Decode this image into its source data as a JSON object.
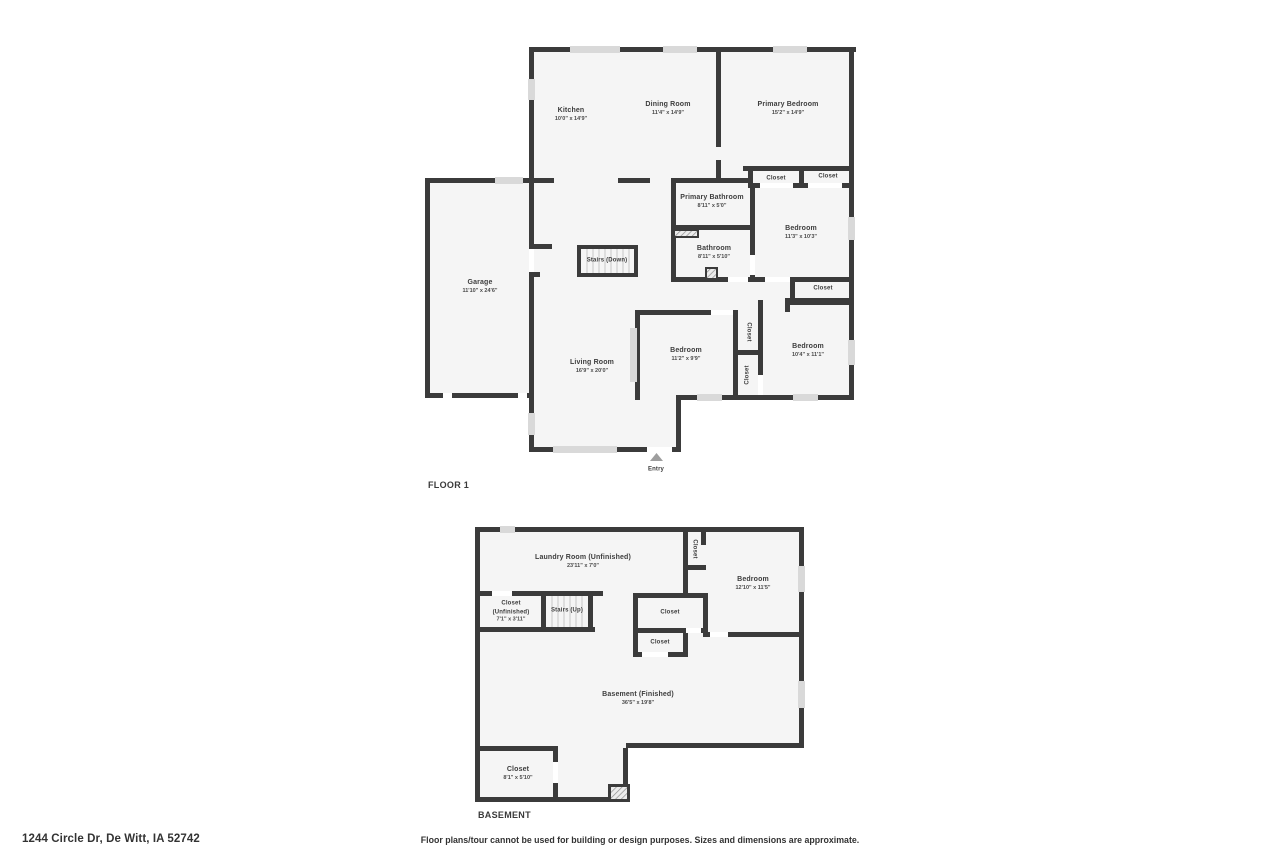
{
  "floor1": {
    "title": "FLOOR 1",
    "rooms": [
      {
        "name": "Kitchen",
        "dims": "10'0\" x 14'9\""
      },
      {
        "name": "Dining Room",
        "dims": "11'4\" x 14'9\""
      },
      {
        "name": "Primary Bedroom",
        "dims": "15'2\" x 14'9\""
      },
      {
        "name": "Closet"
      },
      {
        "name": "Closet"
      },
      {
        "name": "Primary Bathroom",
        "dims": "8'11\" x 5'0\""
      },
      {
        "name": "Bedroom",
        "dims": "11'3\" x 10'3\""
      },
      {
        "name": "Bathroom",
        "dims": "8'11\" x 5'10\""
      },
      {
        "name": "Closet"
      },
      {
        "name": "Stairs (Down)"
      },
      {
        "name": "Garage",
        "dims": "11'10\" x 24'6\""
      },
      {
        "name": "Living Room",
        "dims": "16'9\" x 20'0\""
      },
      {
        "name": "Bedroom",
        "dims": "11'2\" x 9'9\""
      },
      {
        "name": "Closet"
      },
      {
        "name": "Closet"
      },
      {
        "name": "Bedroom",
        "dims": "10'4\" x 11'1\""
      },
      {
        "name": "Entry"
      }
    ]
  },
  "basement": {
    "title": "BASEMENT",
    "rooms": [
      {
        "name": "Laundry Room (Unfinished)",
        "dims": "23'11\" x 7'0\""
      },
      {
        "name": "Closet"
      },
      {
        "name": "Bedroom",
        "dims": "12'10\" x 11'5\""
      },
      {
        "name": "Closet",
        "name2": "(Unfinished)",
        "dims": "7'1\" x 3'11\""
      },
      {
        "name": "Stairs (Up)"
      },
      {
        "name": "Closet"
      },
      {
        "name": "Closet"
      },
      {
        "name": "Basement (Finished)",
        "dims": "36'5\" x 19'8\""
      },
      {
        "name": "Closet",
        "dims": "8'1\" x 5'10\""
      }
    ]
  },
  "footer": {
    "address": "1244 Circle Dr, De Witt, IA 52742",
    "disclaimer": "Floor plans/tour cannot be used for building or design purposes. Sizes and dimensions are approximate."
  },
  "colors": {
    "wall": "#3b3b3b",
    "room_fill": "#f5f5f5",
    "window": "#d9d9d9",
    "entry_arrow": "#9e9e9e"
  }
}
